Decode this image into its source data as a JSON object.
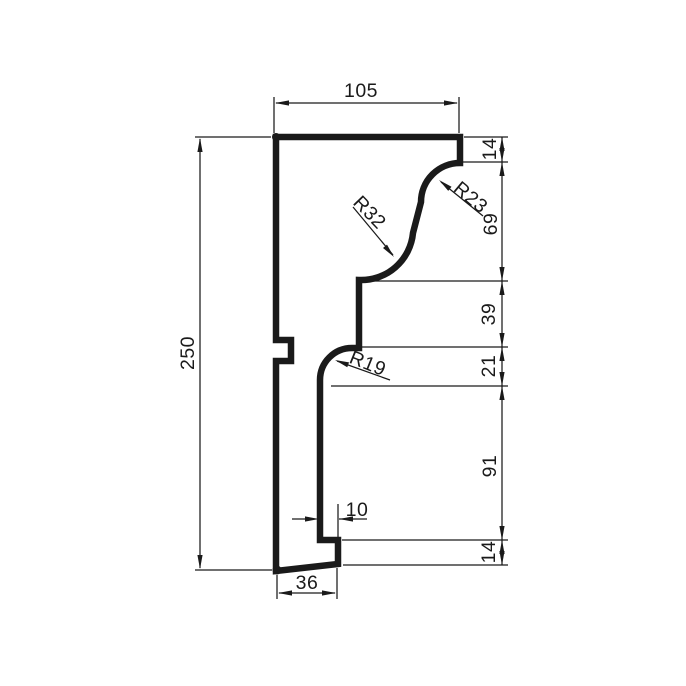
{
  "drawing": {
    "type": "technical-profile-cross-section",
    "background": "#ffffff",
    "stroke_color": "#1a1a1a",
    "font_size": 19.5,
    "profile": {
      "path": "M 276 137 L 460 137 L 460 163 A 39 39 0 0 0 421 202 L 413 233 A 52 52 0 0 1 359 280 L 359 348 L 352 348 A 32 32 0 0 0 320 380 L 320 540 L 338 540 L 338 564 L 276 571 L 276 361 L 291 361 L 291 340 L 276 340 Z",
      "stroke_width": 6.5
    },
    "thin_stroke_width": 1.25,
    "arrow": {
      "length": 14,
      "half_width": 2.6
    },
    "thin_lines": [
      {
        "name": "ext-line-250-top",
        "x1": 195,
        "y1": 137,
        "x2": 271,
        "y2": 137
      },
      {
        "name": "ext-line-250-bottom",
        "x1": 195,
        "y1": 570,
        "x2": 272,
        "y2": 570
      },
      {
        "name": "dim-line-250",
        "x1": 200,
        "y1": 139,
        "x2": 200,
        "y2": 568
      },
      {
        "name": "ext-line-105-left",
        "x1": 274,
        "y1": 97,
        "x2": 274,
        "y2": 133
      },
      {
        "name": "ext-line-105-right",
        "x1": 459,
        "y1": 97,
        "x2": 459,
        "y2": 133
      },
      {
        "name": "dim-line-105",
        "x1": 276,
        "y1": 103,
        "x2": 457,
        "y2": 103
      },
      {
        "name": "dim-line-right-chain",
        "x1": 502,
        "y1": 137,
        "x2": 502,
        "y2": 565
      },
      {
        "name": "ext-line-chain-top",
        "x1": 464,
        "y1": 137,
        "x2": 508,
        "y2": 137
      },
      {
        "name": "ext-line-chain-14",
        "x1": 463,
        "y1": 162,
        "x2": 508,
        "y2": 162
      },
      {
        "name": "ext-line-chain-69",
        "x1": 362,
        "y1": 281,
        "x2": 508,
        "y2": 281
      },
      {
        "name": "ext-line-chain-39",
        "x1": 362,
        "y1": 347,
        "x2": 508,
        "y2": 347
      },
      {
        "name": "ext-line-chain-21",
        "x1": 331,
        "y1": 386,
        "x2": 508,
        "y2": 386
      },
      {
        "name": "ext-line-chain-91",
        "x1": 342,
        "y1": 540,
        "x2": 508,
        "y2": 540
      },
      {
        "name": "ext-line-chain-bottom",
        "x1": 343,
        "y1": 565,
        "x2": 508,
        "y2": 565
      },
      {
        "name": "ext-line-10-right",
        "x1": 338,
        "y1": 504,
        "x2": 338,
        "y2": 552
      },
      {
        "name": "dim-line-10-left-tail",
        "x1": 292,
        "y1": 519,
        "x2": 306,
        "y2": 519
      },
      {
        "name": "dim-line-10-right-tail",
        "x1": 339,
        "y1": 519,
        "x2": 367,
        "y2": 519
      },
      {
        "name": "ext-line-36-left",
        "x1": 277,
        "y1": 575,
        "x2": 277,
        "y2": 599
      },
      {
        "name": "ext-line-36-right",
        "x1": 337,
        "y1": 568,
        "x2": 337,
        "y2": 599
      },
      {
        "name": "dim-line-36",
        "x1": 279,
        "y1": 593,
        "x2": 335,
        "y2": 593
      },
      {
        "name": "leader-line-r32",
        "x1": 353,
        "y1": 207,
        "x2": 393,
        "y2": 255
      },
      {
        "name": "leader-line-r23",
        "x1": 483,
        "y1": 216,
        "x2": 441,
        "y2": 182
      },
      {
        "name": "leader-line-r19",
        "x1": 337,
        "y1": 361,
        "x2": 390,
        "y2": 380
      }
    ],
    "arrows": [
      {
        "name": "arrow-105-left",
        "x": 275,
        "y": 103,
        "angle": 180
      },
      {
        "name": "arrow-105-right",
        "x": 458,
        "y": 103,
        "angle": 0
      },
      {
        "name": "arrow-250-top",
        "x": 200,
        "y": 138,
        "angle": -90
      },
      {
        "name": "arrow-250-bottom",
        "x": 200,
        "y": 569,
        "angle": 90
      },
      {
        "name": "arrow-chain-14t-up",
        "x": 502,
        "y": 137,
        "angle": -90
      },
      {
        "name": "arrow-chain-14t-down",
        "x": 502,
        "y": 162,
        "angle": 90
      },
      {
        "name": "arrow-chain-69-up",
        "x": 502,
        "y": 162,
        "angle": -90
      },
      {
        "name": "arrow-chain-69-down",
        "x": 502,
        "y": 281,
        "angle": 90
      },
      {
        "name": "arrow-chain-39-up",
        "x": 502,
        "y": 281,
        "angle": -90
      },
      {
        "name": "arrow-chain-39-down",
        "x": 502,
        "y": 347,
        "angle": 90
      },
      {
        "name": "arrow-chain-21-up",
        "x": 502,
        "y": 347,
        "angle": -90
      },
      {
        "name": "arrow-chain-21-down",
        "x": 502,
        "y": 386,
        "angle": 90
      },
      {
        "name": "arrow-chain-91-up",
        "x": 502,
        "y": 386,
        "angle": -90
      },
      {
        "name": "arrow-chain-91-down",
        "x": 502,
        "y": 540,
        "angle": 90
      },
      {
        "name": "arrow-chain-14b-up",
        "x": 502,
        "y": 540,
        "angle": -90
      },
      {
        "name": "arrow-chain-14b-down",
        "x": 502,
        "y": 565,
        "angle": 90
      },
      {
        "name": "arrow-10-left",
        "x": 319,
        "y": 519,
        "angle": 0
      },
      {
        "name": "arrow-10-right",
        "x": 339,
        "y": 519,
        "angle": 180
      },
      {
        "name": "arrow-36-left",
        "x": 278,
        "y": 593,
        "angle": 180
      },
      {
        "name": "arrow-36-right",
        "x": 336,
        "y": 593,
        "angle": 0
      },
      {
        "name": "arrow-leader-r32",
        "x": 394,
        "y": 257,
        "angle": 50
      },
      {
        "name": "arrow-leader-r23",
        "x": 439,
        "y": 180,
        "angle": 219
      },
      {
        "name": "arrow-leader-r19",
        "x": 335,
        "y": 360,
        "angle": 200
      }
    ],
    "dots": [
      {
        "name": "corner-dot-top-left",
        "x": 276,
        "y": 137,
        "r": 4
      },
      {
        "name": "corner-dot-bottom-left",
        "x": 277,
        "y": 570,
        "r": 4.5
      }
    ],
    "labels": [
      {
        "name": "dim-label-top-width",
        "text": "105",
        "x": 361,
        "y": 90,
        "rotate": 0
      },
      {
        "name": "dim-label-total-height",
        "text": "250",
        "x": 187,
        "y": 353,
        "rotate": -90
      },
      {
        "name": "dim-label-right-14-top",
        "text": "14",
        "x": 489,
        "y": 149,
        "rotate": -90
      },
      {
        "name": "dim-label-right-69",
        "text": "69",
        "x": 490,
        "y": 224,
        "rotate": -90
      },
      {
        "name": "dim-label-right-39",
        "text": "39",
        "x": 488,
        "y": 314,
        "rotate": -90
      },
      {
        "name": "dim-label-right-21",
        "text": "21",
        "x": 488,
        "y": 366,
        "rotate": -90
      },
      {
        "name": "dim-label-right-91",
        "text": "91",
        "x": 489,
        "y": 466,
        "rotate": -90
      },
      {
        "name": "dim-label-right-14-bottom",
        "text": "14",
        "x": 488,
        "y": 552,
        "rotate": -90
      },
      {
        "name": "dim-label-step-width",
        "text": "10",
        "x": 357,
        "y": 509,
        "rotate": 0
      },
      {
        "name": "dim-label-bottom-width",
        "text": "36",
        "x": 307,
        "y": 582,
        "rotate": 0
      },
      {
        "name": "radius-label-r32",
        "text": "R32",
        "x": 370,
        "y": 212,
        "rotate": 46
      },
      {
        "name": "radius-label-r23",
        "text": "R23",
        "x": 471,
        "y": 197,
        "rotate": 40
      },
      {
        "name": "radius-label-r19",
        "text": "R19",
        "x": 368,
        "y": 363,
        "rotate": 22
      }
    ]
  },
  "dimensions_summary": {
    "top_width": "105",
    "total_height": "250",
    "right_chain": [
      "14",
      "69",
      "39",
      "21",
      "91",
      "14"
    ],
    "step_width": "10",
    "bottom_width": "36",
    "radii": [
      "R32",
      "R23",
      "R19"
    ]
  }
}
